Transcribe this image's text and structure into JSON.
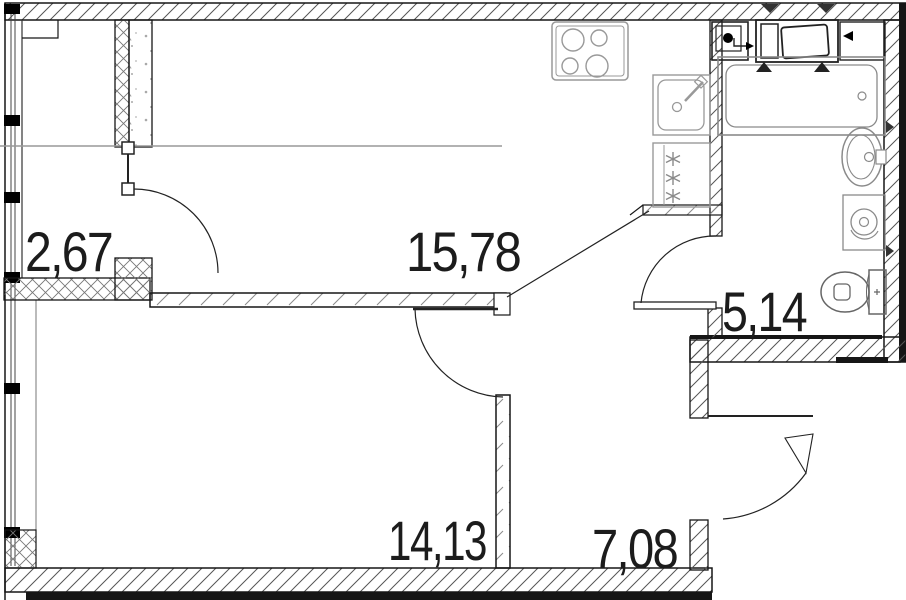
{
  "plan": {
    "type": "apartment-floor-plan",
    "rooms": [
      {
        "id": "wardrobe",
        "area": "2,67"
      },
      {
        "id": "kitchen-living-room",
        "area": "15,78"
      },
      {
        "id": "bathroom",
        "area": "5,14"
      },
      {
        "id": "bedroom",
        "area": "14,13"
      },
      {
        "id": "hallway",
        "area": "7,08"
      }
    ],
    "fixtures": [
      "stove-icon",
      "kitchen-sink-icon",
      "fridge-icon",
      "vent-shaft-icon",
      "washing-machine-icon",
      "countertop-icon",
      "bathtub-icon",
      "washbasin-icon",
      "water-heater-icon",
      "toilet-icon"
    ],
    "colors": {
      "wall_line": "#161616",
      "hatch_line": "#555555",
      "fixture_line": "#8a8a8a",
      "appliance_line": "#222222",
      "label": "#1c1c1c",
      "background": "#ffffff"
    }
  }
}
